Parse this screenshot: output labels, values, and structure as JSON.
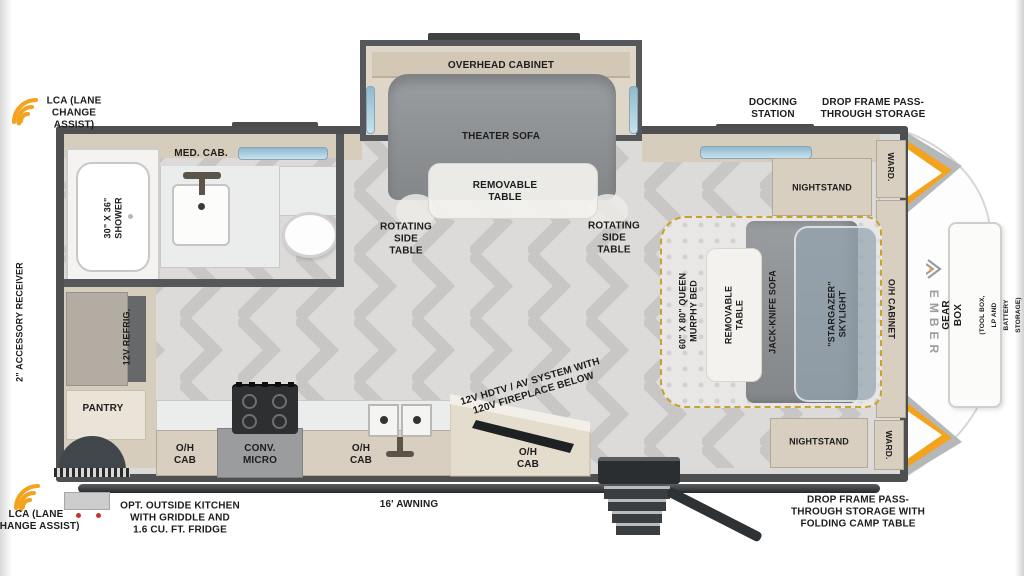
{
  "colors": {
    "accent_orange": "#f3a31e",
    "wall_gray": "#4d4f50",
    "cabinet_beige": "#d9cfc0",
    "sofa_gray": "#8e9193",
    "window_blue": "#b5d6e6",
    "bed_border_gold": "#c9a22b",
    "floor_gray": "#dbdad8"
  },
  "exterior": {
    "lca_top": "LCA (LANE\nCHANGE\nASSIST)",
    "lca_bottom": "LCA (LANE\nCHANGE ASSIST)",
    "accessory_receiver": "2\" ACCESSORY RECEIVER",
    "docking_station": "DOCKING\nSTATION",
    "drop_frame_top": "DROP FRAME PASS-\nTHROUGH STORAGE",
    "drop_frame_bottom": "DROP FRAME PASS-\nTHROUGH STORAGE WITH\nFOLDING CAMP TABLE",
    "outside_kitchen": "OPT. OUTSIDE KITCHEN\nWITH GRIDDLE AND\n1.6 CU. FT. FRIDGE",
    "awning": "16' AWNING",
    "gear_box_title": "GEAR BOX",
    "gear_box_sub": "(TOOL BOX, LP AND\nBATTERY STORAGE)",
    "brand": "EMBER"
  },
  "living": {
    "overhead_cabinet": "OVERHEAD CABINET",
    "theater_sofa": "THEATER SOFA",
    "removable_table": "REMOVABLE\nTABLE",
    "rotating_left": "ROTATING\nSIDE\nTABLE",
    "rotating_right": "ROTATING\nSIDE\nTABLE",
    "hdtv": "12V HDTV / AV SYSTEM WITH\n120V FIREPLACE BELOW"
  },
  "bath": {
    "med_cab": "MED. CAB.",
    "shower": "30\" X 36\"\nSHOWER"
  },
  "kitchen": {
    "refrig": "12V REFRIG.",
    "pantry": "PANTRY",
    "oh_cab_left": "O/H\nCAB",
    "conv_micro": "CONV.\nMICRO",
    "oh_cab_mid": "O/H\nCAB",
    "oh_cab_right": "O/H\nCAB"
  },
  "bedroom": {
    "nightstand_top": "NIGHTSTAND",
    "nightstand_bottom": "NIGHTSTAND",
    "ward_top": "WARD.",
    "ward_bottom": "WARD.",
    "murphy_bed": "60\" X 80\" QUEEN\nMURPHY BED",
    "removable_table": "REMOVABLE\nTABLE",
    "jack_knife_sofa": "JACK-KNIFE SOFA",
    "stargazer": "\"STARGAZER\"\nSKYLIGHT",
    "oh_cabinet": "O/H CABINET"
  }
}
